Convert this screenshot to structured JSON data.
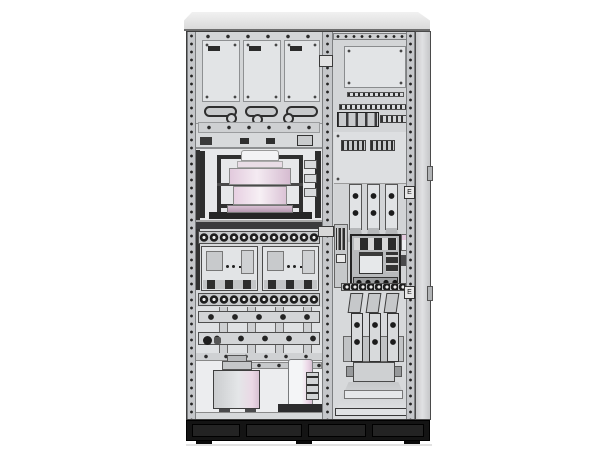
{
  "meta": {
    "description": "CAD render of a low-voltage switchgear / distribution cabinet, front view with doors open, two bays",
    "background": "#ffffff"
  },
  "colors": {
    "background": "#ffffff",
    "shell": "#d7d9db",
    "panel_light": "#e2e4e6",
    "panel_mid": "#d3d5d7",
    "panel_dark": "#c6c8ca",
    "frame_dark": "#2d2d2d",
    "outline": "#3c3c3c",
    "plinth": "#141414",
    "pink_light": "#f4ebf2",
    "pink": "#e7d0e2",
    "pink_dark": "#d6bcd1",
    "white_part": "#f3f3f5",
    "steel": "#b8babc"
  },
  "cabinet": {
    "left_bay": {
      "door_panels": {
        "count": 3,
        "labels_legible": false,
        "label_marks": 3
      },
      "handles": 3,
      "lock_circles": 3,
      "transformer_cylindrical": {
        "color": "pink/white",
        "frame": "dark steel"
      },
      "bushings_right": 3,
      "terminal_rows": [
        {
          "terminals": 12
        },
        {
          "terminals": 12
        }
      ],
      "breakers": {
        "count": 2,
        "type": "MCCB"
      },
      "busbars_horizontal": {
        "count": 2,
        "holes_each": 5
      },
      "busbar_links_vertical": 4,
      "bottom_compartment": {
        "transformer_box": 1,
        "capacitor_cylinder": 1
      }
    },
    "right_bay": {
      "vent_panel_screws": 8,
      "louver_strips": 2,
      "din_terminal_blocks": 4,
      "terminal_groups": 2,
      "vertical_busbars_upper": 3,
      "air_circuit_breaker": 1,
      "vertical_busbars_lower": {
        "count": 3,
        "holes_each": 2
      },
      "pedestal": "trapezoid cable-termination base",
      "earth_labels": [
        "E",
        "E"
      ]
    },
    "frame": {
      "perforated_rails": 3,
      "hinge_tabs_right_wall": 2
    },
    "plinth": {
      "color": "#141414",
      "segments": 4,
      "feet": 3
    }
  }
}
